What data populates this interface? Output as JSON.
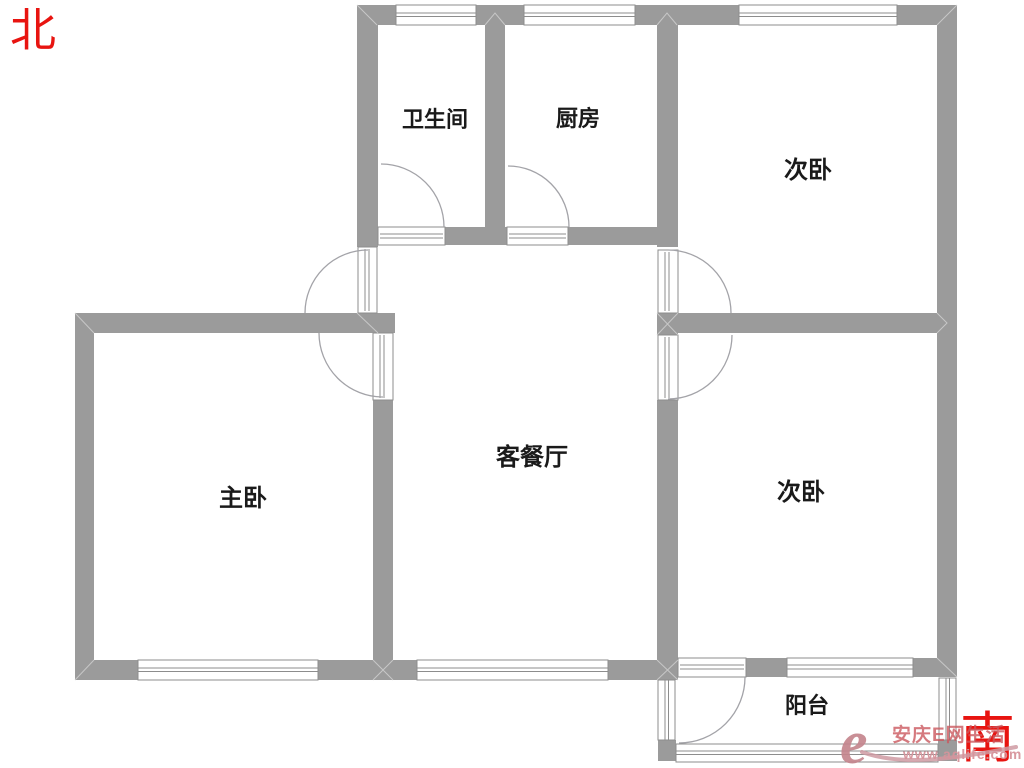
{
  "title": "apartment-floor-plan",
  "compass": {
    "north_label": "北",
    "south_label": "南",
    "color": "#e81410"
  },
  "rooms": [
    {
      "id": "bathroom",
      "label": "卫生间"
    },
    {
      "id": "kitchen",
      "label": "厨房"
    },
    {
      "id": "bedroom-ne",
      "label": "次卧"
    },
    {
      "id": "master-bedroom",
      "label": "主卧"
    },
    {
      "id": "living-dining",
      "label": "客餐厅"
    },
    {
      "id": "bedroom-se",
      "label": "次卧"
    },
    {
      "id": "balcony",
      "label": "阳台"
    }
  ],
  "watermark": {
    "logo_glyph": "e",
    "site_name": "安庆E网生活",
    "site_url": "www.aqlife.com",
    "logo_color": "#c5868e",
    "text_color": "#cb585e",
    "url_color": "#d7949b"
  },
  "plan_colors": {
    "wall": "#9b9b9b",
    "opening_stroke": "#8d8d8d",
    "door_arc": "#a3a3a8",
    "label_text": "#1a1a1a",
    "background": "#ffffff"
  }
}
